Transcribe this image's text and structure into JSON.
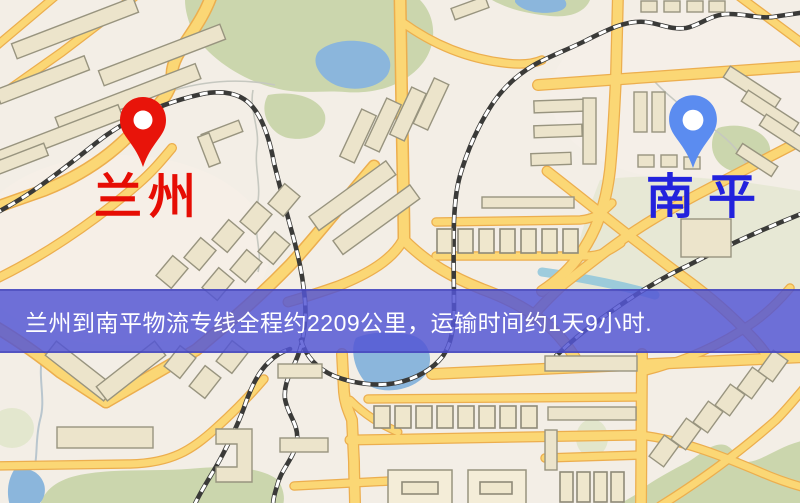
{
  "theme": {
    "map-bg": "#f3eee6",
    "banner-bg": "rgba(84,86,212,0.84)",
    "banner-border": "rgba(62,62,176,0.55)",
    "banner-text-color": "#ffffff",
    "pin-red": "#e8140a",
    "pin-blue": "#5b8cf0",
    "label-red": "#e60d04",
    "label-blue": "#2222dd"
  },
  "map": {
    "markers": [
      {
        "id": "lanzhou",
        "label": "兰州"
      },
      {
        "id": "nanping",
        "label": "南平"
      }
    ],
    "banner": {
      "text": "兰州到南平物流专线全程约2209公里，运输时间约1天9小时."
    }
  }
}
